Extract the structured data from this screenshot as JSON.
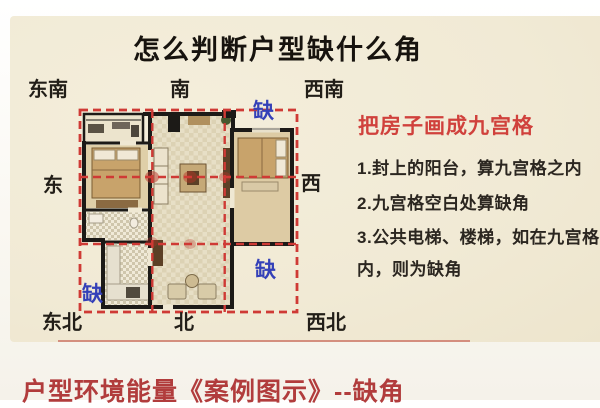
{
  "title": "怎么判断户型缺什么角",
  "compass": {
    "se": "东南",
    "s": "南",
    "sw": "西南",
    "e": "东",
    "w": "西",
    "ne": "东北",
    "n": "北",
    "nw": "西北"
  },
  "floorplan": {
    "missing_label": "缺"
  },
  "right_panel": {
    "heading": "把房子画成九宫格",
    "lines": [
      "1.封上的阳台，算九宫格之内",
      "2.九宫格空白处算缺角",
      "3.公共电梯、楼梯，如在九宫格",
      "内，则为缺角"
    ]
  },
  "footer": {
    "caption": "户型环境能量《案例图示》--缺角"
  },
  "colors": {
    "grid_red": "#cf3a35",
    "missing_blue": "#3440b8",
    "heading_red": "#d0413c",
    "footer_red": "#b13c3c",
    "card_cream": "#f1ead5"
  }
}
